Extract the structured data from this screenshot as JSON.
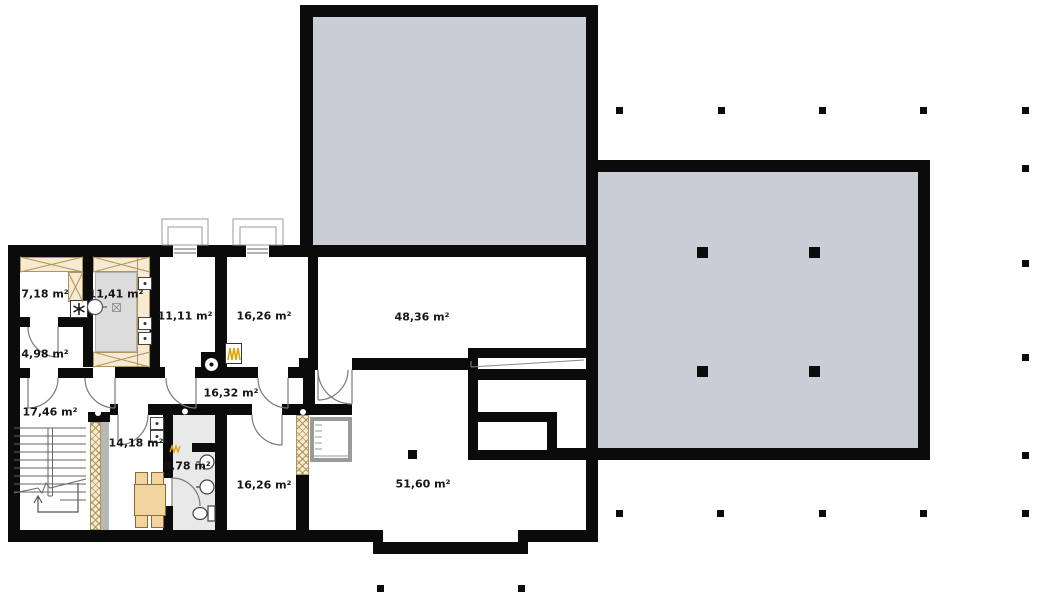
{
  "plan": {
    "type": "architectural-floor-plan",
    "area_unit": "m²",
    "rooms": [
      {
        "id": "room-a",
        "area_label": "7,18 m²",
        "x": 45,
        "y": 294
      },
      {
        "id": "room-b",
        "area_label": "11,41 m²",
        "x": 116,
        "y": 294
      },
      {
        "id": "room-c",
        "area_label": "11,11 m²",
        "x": 185,
        "y": 316
      },
      {
        "id": "room-d",
        "area_label": "16,26 m²",
        "x": 264,
        "y": 316
      },
      {
        "id": "room-e",
        "area_label": "48,36 m²",
        "x": 422,
        "y": 317
      },
      {
        "id": "room-f",
        "area_label": "4,98 m²",
        "x": 45,
        "y": 354
      },
      {
        "id": "hall",
        "area_label": "16,32 m²",
        "x": 231,
        "y": 393
      },
      {
        "id": "stair-hall",
        "area_label": "17,46 m²",
        "x": 50,
        "y": 412
      },
      {
        "id": "room-g",
        "area_label": "14,18 m²",
        "x": 136,
        "y": 443
      },
      {
        "id": "bathroom",
        "area_label": "8,78 m²",
        "x": 187,
        "y": 466
      },
      {
        "id": "room-h",
        "area_label": "16,26 m²",
        "x": 264,
        "y": 485
      },
      {
        "id": "room-i",
        "area_label": "51,60 m²",
        "x": 423,
        "y": 484
      }
    ],
    "column_markers": {
      "small": [
        [
          619,
          110
        ],
        [
          721,
          110
        ],
        [
          822,
          110
        ],
        [
          923,
          110
        ],
        [
          1025,
          110
        ],
        [
          1025,
          168
        ],
        [
          1025,
          263
        ],
        [
          1025,
          357
        ],
        [
          1025,
          455
        ],
        [
          1025,
          513
        ],
        [
          619,
          513
        ],
        [
          720,
          513
        ],
        [
          822,
          513
        ],
        [
          923,
          513
        ],
        [
          380,
          588
        ],
        [
          521,
          588
        ]
      ],
      "medium": [
        [
          412,
          454
        ]
      ],
      "large": [
        [
          702,
          252
        ],
        [
          814,
          252
        ],
        [
          702,
          371
        ],
        [
          814,
          371
        ]
      ]
    },
    "colors": {
      "wall": "#0b0b0b",
      "terrace_slab": "#caccd6",
      "wardrobe_hatch": "#f6ead0",
      "hatch_line": "#b09460",
      "bathroom_floor": "#e9e9e9",
      "closet_gray": "#dcdcdc",
      "furniture": "#f2d49e",
      "radiator_yellow": "#dca70a",
      "thin_line": "#777777"
    }
  }
}
